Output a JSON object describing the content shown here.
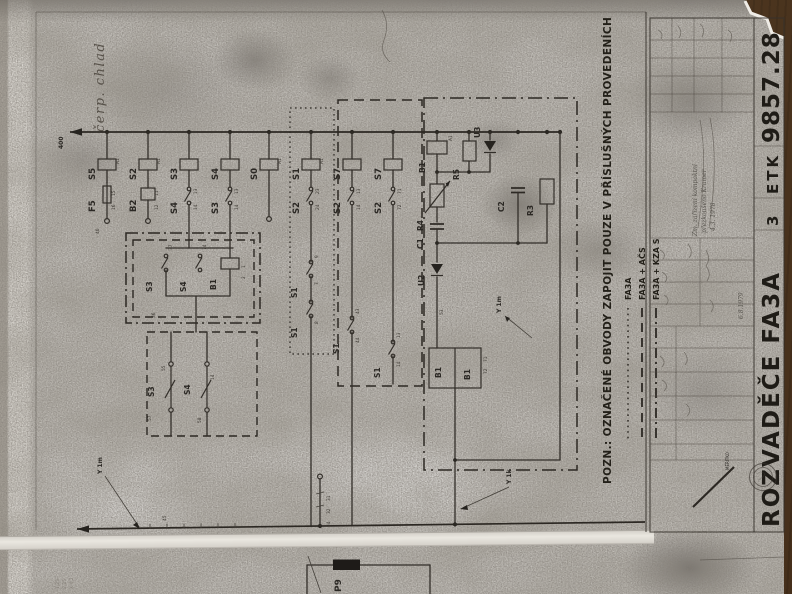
{
  "scene": {
    "description": "Photocopied electrical schematic sheet lying on a wooden table",
    "wood_color": "#6b4e2f",
    "paper_color": "#c7c4be",
    "ink_color": "#2b2824"
  },
  "margins": {
    "handwritten_top_left": "čerp. chlad",
    "pencil_notes": [
      "1,25",
      "2,25",
      "X 4,2"
    ]
  },
  "schematic": {
    "bus_label": "400",
    "coil_term": "A1",
    "columns": [
      {
        "id": "S5",
        "sub": "F5",
        "sub_t1": "15",
        "sub_t2": "16",
        "foot": "40"
      },
      {
        "id": "S2",
        "sub": "B2",
        "sub_t1": "11",
        "sub_t2": "12",
        "foot": ""
      },
      {
        "id": "S3",
        "sub": "S4",
        "sub_t1": "13",
        "sub_t2": "14",
        "foot": ""
      },
      {
        "id": "S4",
        "sub": "S3",
        "sub_t1": "13",
        "sub_t2": "14",
        "foot": ""
      },
      {
        "id": "S0",
        "sub": "",
        "sub_t1": "",
        "sub_t2": "",
        "foot": ""
      },
      {
        "id": "S1",
        "sub": "S2",
        "sub_t1": "23",
        "sub_t2": "24",
        "foot": ""
      },
      {
        "id": "S7",
        "sub": "S2",
        "sub_t1": "13",
        "sub_t2": "14",
        "foot": ""
      },
      {
        "id": "S7",
        "sub": "S2",
        "sub_t1": "71",
        "sub_t2": "72",
        "foot": ""
      }
    ],
    "group_left_upper": {
      "c1": "S3",
      "c2": "S4",
      "dev": "B1",
      "t37": "37",
      "t36": "36",
      "t74": "74",
      "t1": "1",
      "t2": "2"
    },
    "group_left_lower": {
      "c1": "S3",
      "c2": "S4",
      "t57": "57",
      "t55": "55",
      "t58": "58",
      "t14": "14"
    },
    "group_dotted": {
      "c1": "S1",
      "c2": "S1",
      "t9": "9",
      "t7": "7",
      "t8": "8"
    },
    "group_dashed": {
      "c1": "S1",
      "c2": "S1",
      "t43": "43",
      "t44": "44",
      "t13": "13",
      "t14": "14"
    },
    "group_right": {
      "b1": "B1",
      "r5": "R5",
      "u3": "U3",
      "r4": "R4",
      "c1": "C1",
      "c2": "C2",
      "r3": "R3",
      "u2": "U2",
      "u2_term": "53",
      "b1a": "B1",
      "b1b": "B1",
      "t71": "71",
      "t72": "72",
      "cable": "Y 1m"
    },
    "bottom": {
      "wire45": "45",
      "p9_t1": "31",
      "p9_t2": "32",
      "p9_t3": "34",
      "cable_left": "Y 1m",
      "cable_mid": "Y 1k"
    }
  },
  "note": {
    "text": "POZN.: OZNAČENÉ OBVODY ZAPOJIT POUZE V PŘÍSLUŠNÝCH PROVEDENÍCH",
    "legend": [
      {
        "style": "dotted",
        "label": "FA3A"
      },
      {
        "style": "dashed",
        "label": "FA3A + AČS"
      },
      {
        "style": "dash-dot",
        "label": "FA3A + KZA S"
      }
    ]
  },
  "title_block": {
    "number": "9857.28",
    "org": "ETK",
    "sheet": "3",
    "title": "ROZVADĚČE FA3A",
    "scale_label": "MĚŘÍTKO",
    "date": "6.8.1979",
    "notes": [
      "Zm. zařízení kompaktní",
      "přezkoušeno Kramer",
      "4.3. 1978"
    ]
  },
  "second_sheet": {
    "component": "P9"
  }
}
